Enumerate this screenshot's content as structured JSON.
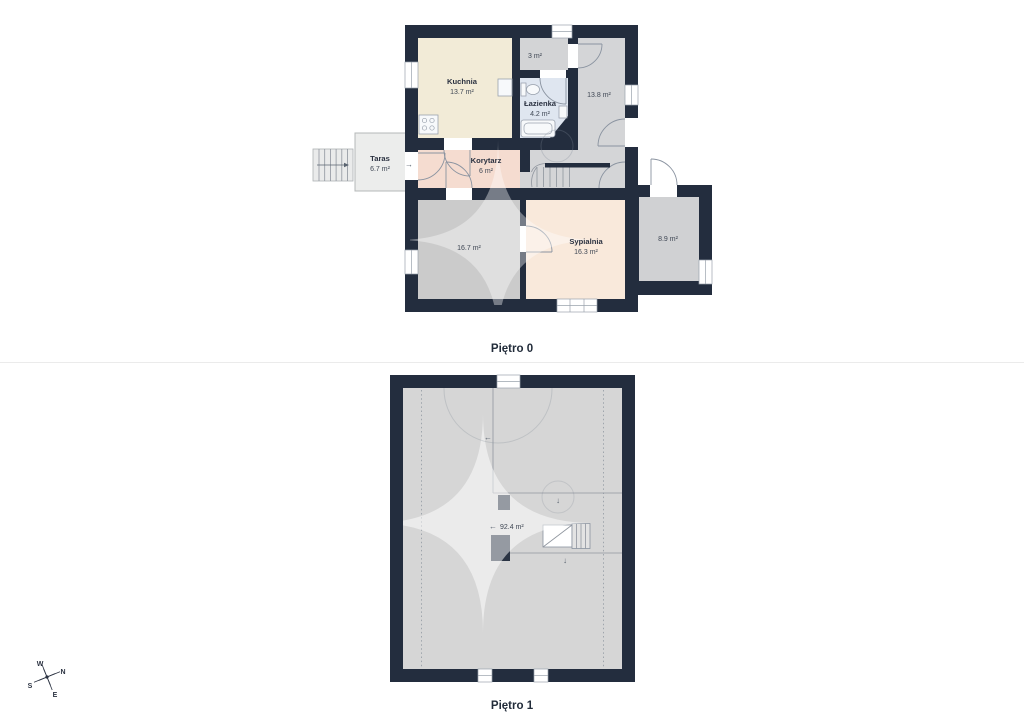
{
  "floors": [
    {
      "label": "Piętro 0",
      "rooms": [
        {
          "name": "Kuchnia",
          "area": "13.7 m²"
        },
        {
          "name": "",
          "area": "3 m²"
        },
        {
          "name": "Łazienka",
          "area": "4.2 m²"
        },
        {
          "name": "",
          "area": "13.8 m²"
        },
        {
          "name": "Taras",
          "area": "6.7 m²"
        },
        {
          "name": "Korytarz",
          "area": "6 m²"
        },
        {
          "name": "",
          "area": "16.7 m²"
        },
        {
          "name": "Sypialnia",
          "area": "16.3 m²"
        },
        {
          "name": "",
          "area": "8.9 m²"
        }
      ]
    },
    {
      "label": "Piętro 1",
      "rooms": [
        {
          "name": "",
          "area": "92.4 m²"
        }
      ]
    }
  ],
  "compass": {
    "north": "N",
    "south": "S",
    "east": "E",
    "west": "W"
  },
  "glyphs": {
    "arrow_right": "→",
    "arrow_left": "←",
    "arrow_down": "↓"
  },
  "colors": {
    "wall": "#232d3e",
    "kuchnia": "#f2ebd7",
    "korytarz": "#f5dcd0",
    "sypialnia": "#f9e9db",
    "lazienka": "#dfe6f0",
    "room3": "#d3d4d6",
    "room138": "#d4d5d7",
    "room167": "#cbcbcb",
    "room89": "#d0d1d3",
    "taras": "#ecedec",
    "attic": "#d6d6d6"
  }
}
